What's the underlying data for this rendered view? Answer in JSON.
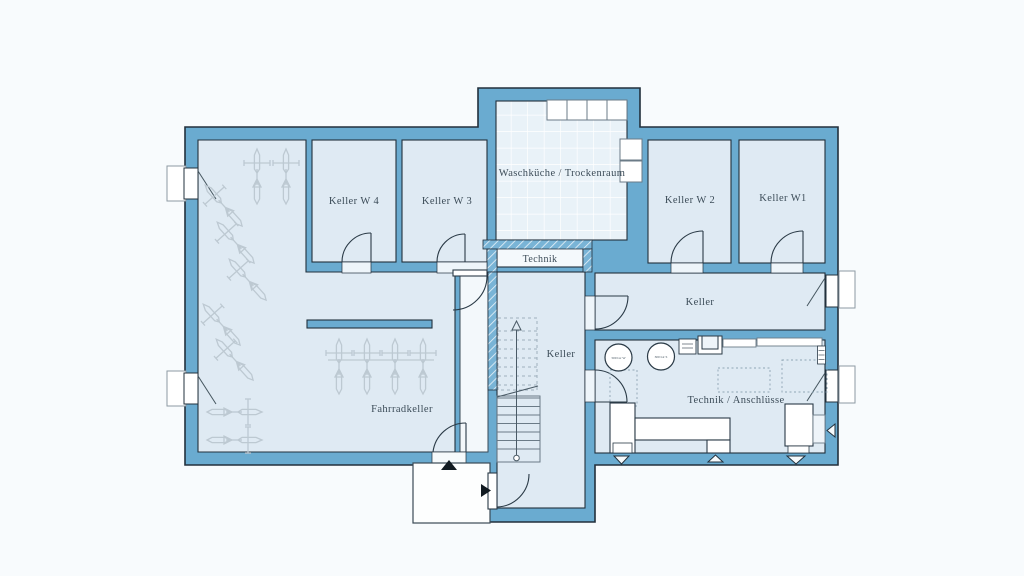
{
  "plan": {
    "type": "floor-plan",
    "level": "Kellergeschoss",
    "colors": {
      "wall_fill": "#6aabd0",
      "wall_outline": "#22303c",
      "room_fill": "#dfeaf3",
      "tile_fill": "#e9f2f8",
      "page_background": "#f8fbfd",
      "label_color": "#3c4c58",
      "furniture_outline": "#5f7280",
      "bike_color": "#bdc9d2"
    },
    "rooms": [
      {
        "id": "fahrradkeller",
        "label": "Fahrradkeller"
      },
      {
        "id": "keller-w4",
        "label": "Keller W 4"
      },
      {
        "id": "keller-w3",
        "label": "Keller W 3"
      },
      {
        "id": "waschkueche",
        "label": "Waschküche / Trockenraum"
      },
      {
        "id": "keller-w2",
        "label": "Keller W 2"
      },
      {
        "id": "keller-w1",
        "label": "Keller W1"
      },
      {
        "id": "technik",
        "label": "Technik"
      },
      {
        "id": "keller-corridor",
        "label": "Keller"
      },
      {
        "id": "keller-stair-hall",
        "label": "Keller"
      },
      {
        "id": "technik-anschluesse",
        "label": "Technik / Anschlüsse"
      }
    ],
    "equipment": [
      {
        "id": "tank-1",
        "label": "500 Ltr W"
      },
      {
        "id": "tank-2",
        "label": "300 Ltr S"
      }
    ],
    "features": {
      "bicycles": 13,
      "windows": 4,
      "door_openings": 9,
      "stair_flights": 2
    }
  }
}
